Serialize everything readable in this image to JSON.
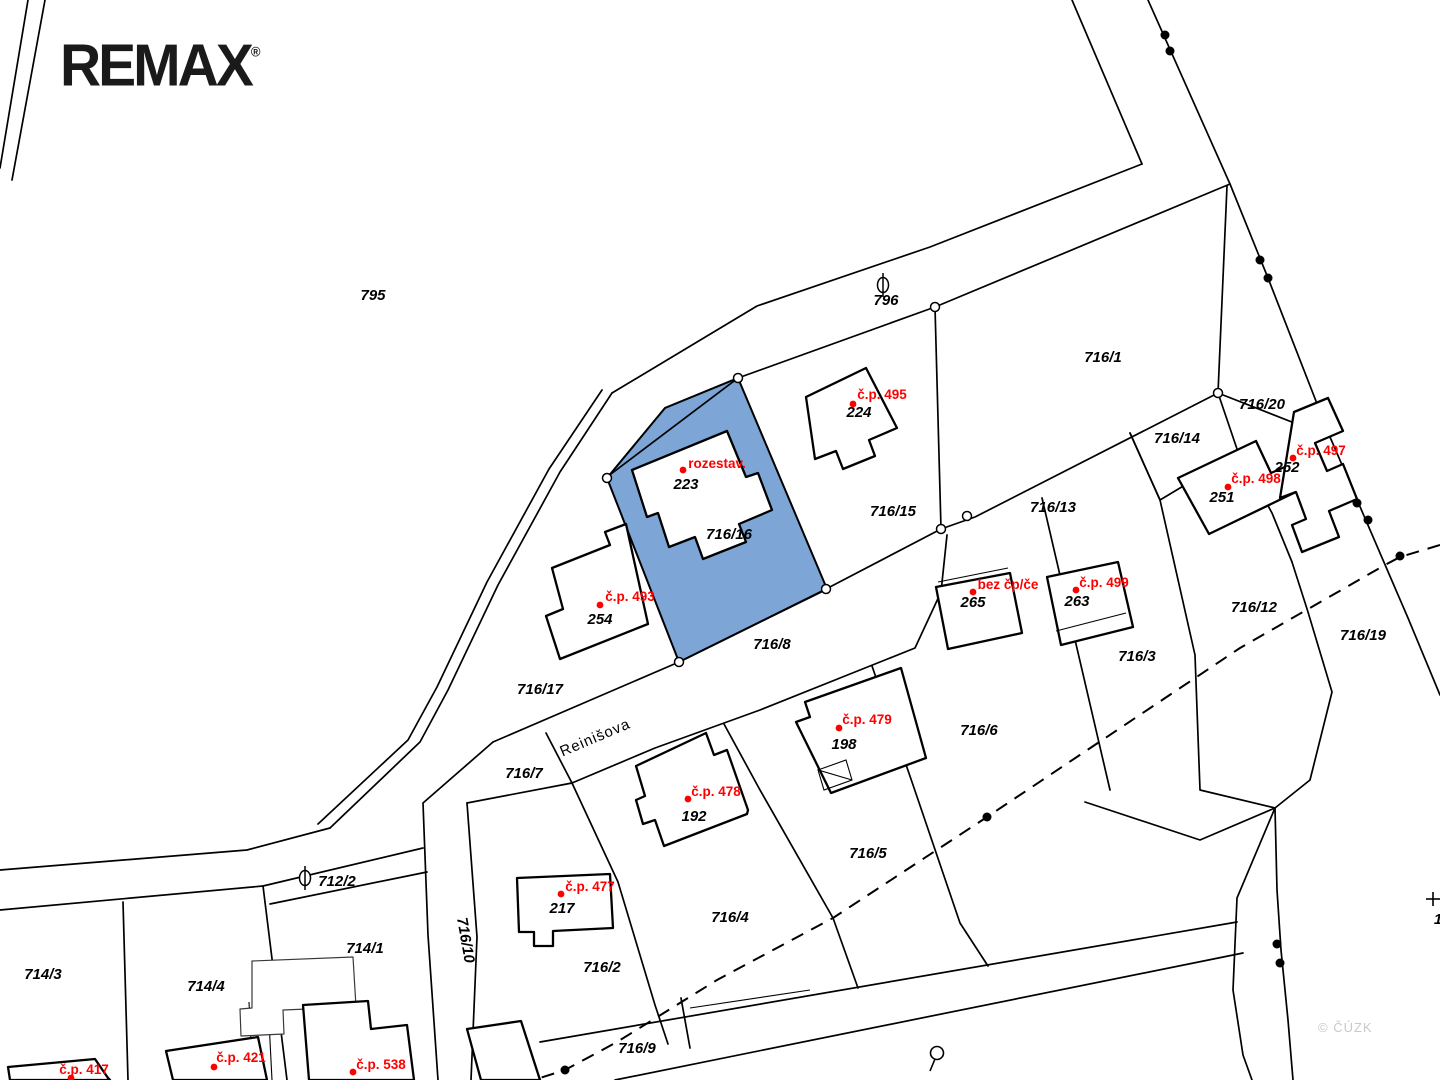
{
  "branding": {
    "logo": "REMAX",
    "registered": "®"
  },
  "watermark": {
    "text": "© ČÚZK"
  },
  "colors": {
    "highlight": "#7DA6D6",
    "label_red": "#FF0000",
    "line": "#000000",
    "watermark": "#C9C9C9"
  },
  "map": {
    "type": "cadastral-map",
    "highlighted_parcel": "716/16",
    "street_name": "Reinišova",
    "parcel_labels": [
      {
        "text": "795",
        "x": 373,
        "y": 300
      },
      {
        "text": "796",
        "x": 886,
        "y": 305
      },
      {
        "text": "716/1",
        "x": 1103,
        "y": 362
      },
      {
        "text": "716/20",
        "x": 1262,
        "y": 409
      },
      {
        "text": "716/14",
        "x": 1177,
        "y": 443
      },
      {
        "text": "716/15",
        "x": 893,
        "y": 516
      },
      {
        "text": "716/13",
        "x": 1053,
        "y": 512
      },
      {
        "text": "716/12",
        "x": 1254,
        "y": 612
      },
      {
        "text": "716/19",
        "x": 1363,
        "y": 640
      },
      {
        "text": "716/16",
        "x": 729,
        "y": 539
      },
      {
        "text": "716/8",
        "x": 772,
        "y": 649
      },
      {
        "text": "716/17",
        "x": 540,
        "y": 694
      },
      {
        "text": "716/3",
        "x": 1137,
        "y": 661
      },
      {
        "text": "716/6",
        "x": 979,
        "y": 735
      },
      {
        "text": "716/7",
        "x": 524,
        "y": 778
      },
      {
        "text": "716/5",
        "x": 868,
        "y": 858
      },
      {
        "text": "716/4",
        "x": 730,
        "y": 922
      },
      {
        "text": "716/2",
        "x": 602,
        "y": 972
      },
      {
        "text": "716/9",
        "x": 637,
        "y": 1053
      },
      {
        "text": "714/1",
        "x": 365,
        "y": 953
      },
      {
        "text": "714/4",
        "x": 206,
        "y": 991
      },
      {
        "text": "714/3",
        "x": 43,
        "y": 979
      },
      {
        "text": "712/2",
        "x": 337,
        "y": 886
      },
      {
        "text": "716/10",
        "x": 461,
        "y": 941,
        "rot": 80
      }
    ],
    "street_label": {
      "text": "Reinišova",
      "x": 597,
      "y": 742,
      "rot": -23
    },
    "building_labels": [
      {
        "text": "223",
        "x": 686,
        "y": 489
      },
      {
        "text": "224",
        "x": 859,
        "y": 417
      },
      {
        "text": "254",
        "x": 600,
        "y": 624
      },
      {
        "text": "251",
        "x": 1222,
        "y": 502
      },
      {
        "text": "252",
        "x": 1287,
        "y": 472
      },
      {
        "text": "265",
        "x": 973,
        "y": 607
      },
      {
        "text": "263",
        "x": 1077,
        "y": 606
      },
      {
        "text": "198",
        "x": 844,
        "y": 749
      },
      {
        "text": "192",
        "x": 694,
        "y": 821
      },
      {
        "text": "217",
        "x": 562,
        "y": 913
      },
      {
        "text": "139",
        "x": 213,
        "y": 1089
      },
      {
        "text": "52",
        "x": 936,
        "y": 1090
      },
      {
        "text": "1",
        "x": 1438,
        "y": 924
      }
    ],
    "red_labels": [
      {
        "text": "rozestav.",
        "x": 717,
        "y": 468,
        "dot": [
          683,
          470
        ]
      },
      {
        "text": "č.p. 495",
        "x": 882,
        "y": 399,
        "dot": [
          853,
          404
        ]
      },
      {
        "text": "č.p. 493",
        "x": 630,
        "y": 601,
        "dot": [
          600,
          605
        ]
      },
      {
        "text": "č.p. 497",
        "x": 1321,
        "y": 455,
        "dot": [
          1293,
          458
        ]
      },
      {
        "text": "č.p. 498",
        "x": 1256,
        "y": 483,
        "dot": [
          1228,
          487
        ]
      },
      {
        "text": "bez čp/če",
        "x": 1008,
        "y": 589,
        "dot": [
          973,
          592
        ]
      },
      {
        "text": "č.p. 499",
        "x": 1104,
        "y": 587,
        "dot": [
          1076,
          590
        ]
      },
      {
        "text": "č.p. 479",
        "x": 867,
        "y": 724,
        "dot": [
          839,
          728
        ]
      },
      {
        "text": "č.p. 478",
        "x": 716,
        "y": 796,
        "dot": [
          688,
          799
        ]
      },
      {
        "text": "č.p. 477",
        "x": 590,
        "y": 891,
        "dot": [
          561,
          894
        ]
      },
      {
        "text": "č.p. 417",
        "x": 84,
        "y": 1074,
        "dot": [
          71,
          1078
        ]
      },
      {
        "text": "č.p. 421",
        "x": 241,
        "y": 1062,
        "dot": [
          214,
          1067
        ]
      },
      {
        "text": "č.p. 538",
        "x": 381,
        "y": 1069,
        "dot": [
          353,
          1072
        ]
      }
    ],
    "symbols": [
      {
        "name": "road-culvert-symbol",
        "x": 883,
        "y": 285
      },
      {
        "name": "road-culvert-symbol",
        "x": 305,
        "y": 878
      },
      {
        "name": "landuse-symbol",
        "x": 937,
        "y": 1053
      },
      {
        "name": "cross-mark",
        "x": 1432,
        "y": 899
      }
    ]
  }
}
